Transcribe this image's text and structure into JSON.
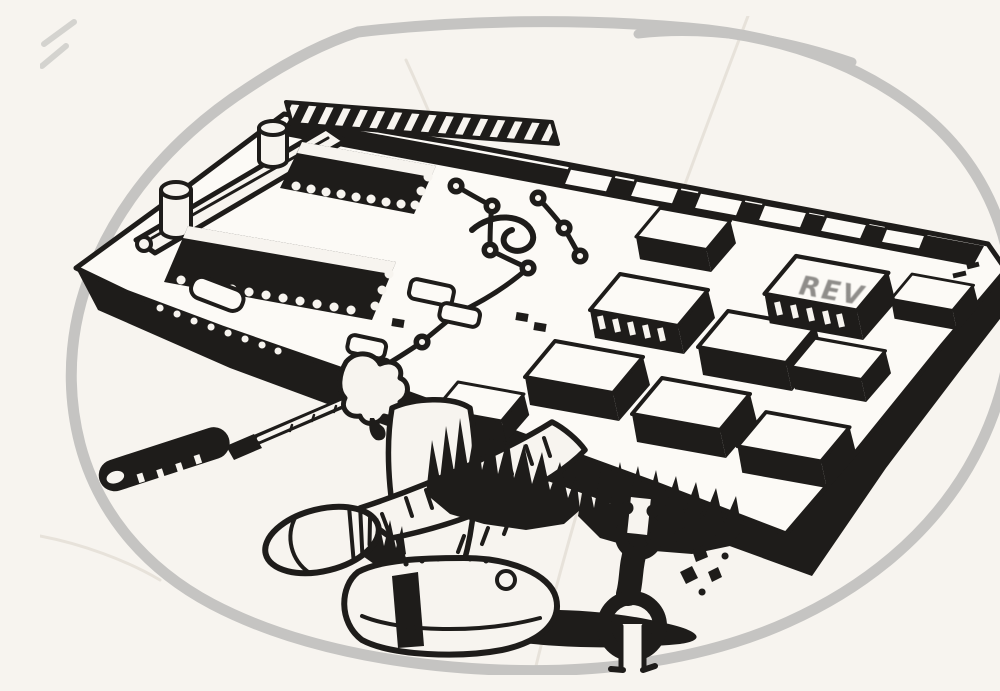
{
  "scene": {
    "description": "Black-and-white scanned cartoon: a technician lies underneath a giant computer circuit board like a mechanic under a car. Hairy crossed legs and worn shoes stick out from beneath the board, a long screwdriver pokes out at lower left, and a double open-end wrench stands beside scattered screws at lower right. A rough grey marker outline rings the sketch.",
    "chip_marking": "REV",
    "colors": {
      "paper": "#f7f4ef",
      "board": "#fcfaf6",
      "ink": "#1e1c1a",
      "outline": "#c5c4c2",
      "handwriting": "#8f8d8a",
      "crease": "#e7e2da"
    }
  }
}
